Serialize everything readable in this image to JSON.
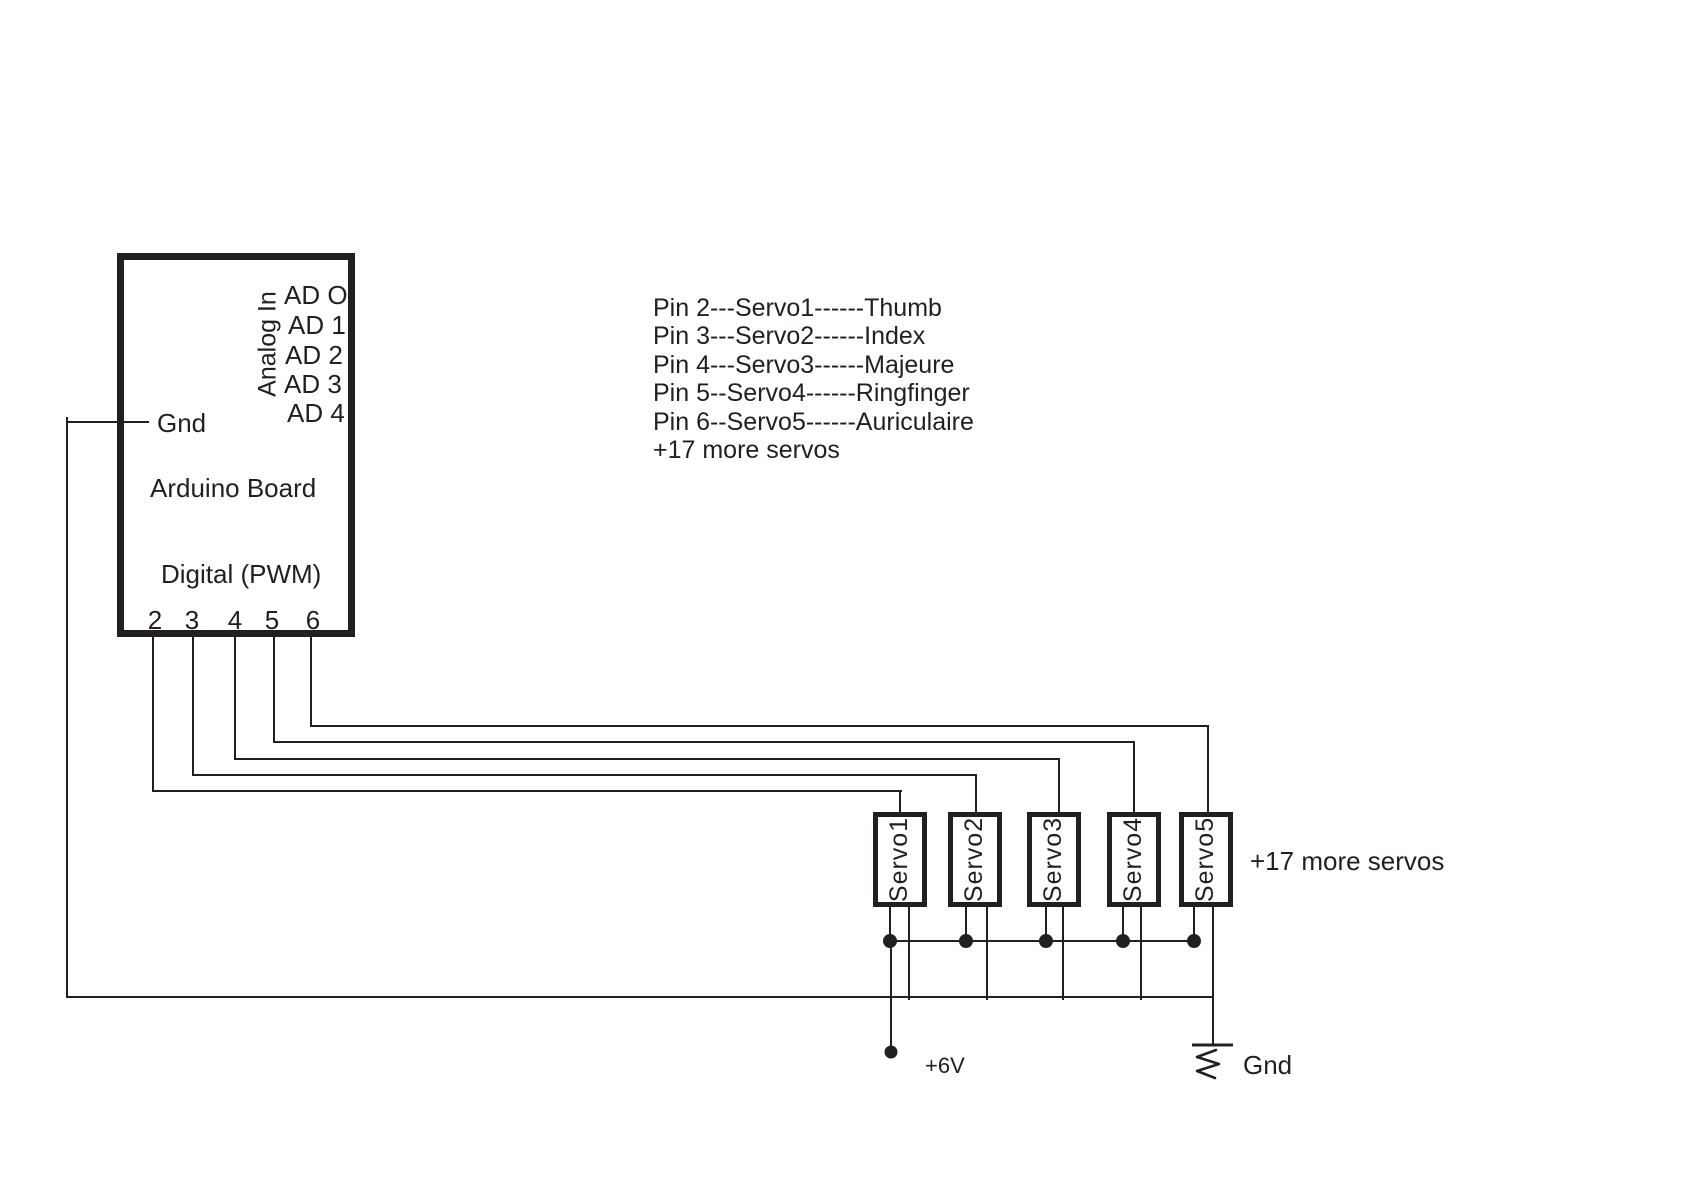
{
  "arduino": {
    "title": "Arduino Board",
    "analog_section_label": "Analog In",
    "analog_pins": [
      "AD O",
      "AD 1",
      "AD 2",
      "AD 3",
      "AD 4"
    ],
    "gnd_label": "Gnd",
    "digital_section_label": "Digital (PWM)",
    "digital_pins": [
      "2",
      "3",
      "4",
      "5",
      "6"
    ]
  },
  "pin_mapping": {
    "lines": [
      "Pin 2---Servo1------Thumb",
      "Pin 3---Servo2------Index",
      "Pin 4---Servo3------Majeure",
      "Pin 5--Servo4------Ringfinger",
      "Pin 6--Servo5------Auriculaire",
      "+17 more servos"
    ]
  },
  "servos": [
    {
      "label": "Servo1"
    },
    {
      "label": "Servo2"
    },
    {
      "label": "Servo3"
    },
    {
      "label": "Servo4"
    },
    {
      "label": "Servo5"
    }
  ],
  "notes": {
    "more_servos_right": "+17 more servos"
  },
  "power": {
    "label": "+6V"
  },
  "ground": {
    "label": "Gnd"
  },
  "colors": {
    "ink": "#231f20",
    "background": "#ffffff"
  }
}
